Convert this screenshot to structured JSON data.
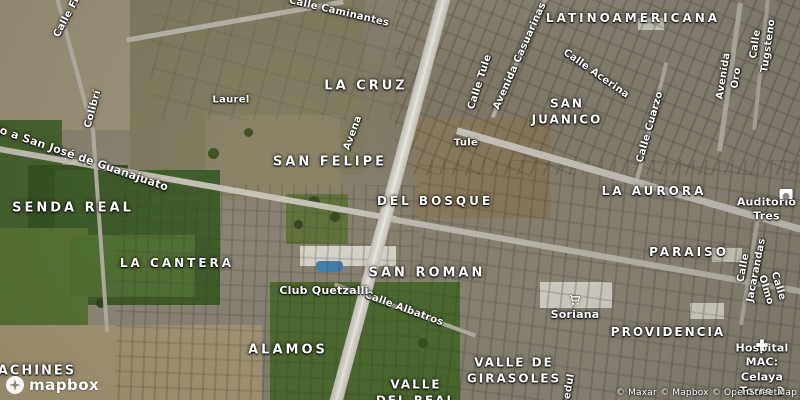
{
  "map": {
    "attribution": "© Maxar © Mapbox © OpenStreetMap",
    "logo_text": "mapbox",
    "colors": {
      "label": "#ffffff",
      "label_halo": "#1f1f1f",
      "highway": "#d4d1c8",
      "field_green": "#46612c",
      "pool_blue": "#3f7fae"
    },
    "area_labels": [
      {
        "text": "LATINOAMERICANA",
        "x": 633,
        "y": 19,
        "s": 12,
        "ls": 3
      },
      {
        "text": "LA CRUZ",
        "x": 366,
        "y": 87,
        "s": 13,
        "ls": 3
      },
      {
        "text": "SAN\nJUANICO",
        "x": 567,
        "y": 112,
        "s": 12,
        "ls": 2
      },
      {
        "text": "SAN FELIPE",
        "x": 330,
        "y": 163,
        "s": 13,
        "ls": 3
      },
      {
        "text": "LA AURORA",
        "x": 654,
        "y": 192,
        "s": 12,
        "ls": 3
      },
      {
        "text": "SENDA REAL",
        "x": 73,
        "y": 209,
        "s": 13,
        "ls": 3
      },
      {
        "text": "DEL BOSQUE",
        "x": 435,
        "y": 202,
        "s": 12,
        "ls": 3
      },
      {
        "text": "PARAISO",
        "x": 689,
        "y": 253,
        "s": 12,
        "ls": 3
      },
      {
        "text": "LA CANTERA",
        "x": 177,
        "y": 264,
        "s": 12,
        "ls": 3
      },
      {
        "text": "SAN ROMAN",
        "x": 427,
        "y": 274,
        "s": 13,
        "ls": 3
      },
      {
        "text": "PROVIDENCIA",
        "x": 668,
        "y": 333,
        "s": 12,
        "ls": 2
      },
      {
        "text": "ALAMOS",
        "x": 288,
        "y": 351,
        "s": 13,
        "ls": 3
      },
      {
        "text": "VALLE DE\nGIRASOLES",
        "x": 514,
        "y": 371,
        "s": 12,
        "ls": 2
      },
      {
        "text": "VALLE\nDEL REAL",
        "x": 416,
        "y": 393,
        "s": 12,
        "ls": 2
      },
      {
        "text": "BACHINES",
        "x": 31,
        "y": 372,
        "s": 13,
        "ls": 2
      }
    ],
    "street_labels": [
      {
        "text": "Calle Caminantes",
        "x": 339,
        "y": 12,
        "r": 13
      },
      {
        "text": "Calle Fr",
        "x": 67,
        "y": 17,
        "r": -62
      },
      {
        "text": "Calle Acerina",
        "x": 596,
        "y": 74,
        "r": 35
      },
      {
        "text": "Avenida Casuarinas",
        "x": 520,
        "y": 56,
        "r": -66
      },
      {
        "text": "Calle Tule",
        "x": 480,
        "y": 82,
        "r": -72
      },
      {
        "text": "Avenida Oro",
        "x": 730,
        "y": 77,
        "r": -81
      },
      {
        "text": "Calle Tugsteno",
        "x": 762,
        "y": 45,
        "r": -82
      },
      {
        "text": "Calle Cuarzo",
        "x": 650,
        "y": 127,
        "r": -74
      },
      {
        "text": "Colibrí",
        "x": 93,
        "y": 109,
        "r": -75
      },
      {
        "text": "Laurel",
        "x": 231,
        "y": 100,
        "r": 0
      },
      {
        "text": "Avena",
        "x": 353,
        "y": 133,
        "r": -70
      },
      {
        "text": "Tule",
        "x": 466,
        "y": 143,
        "r": 0
      },
      {
        "text": "no a San José de Guanajuato",
        "x": 80,
        "y": 158,
        "r": 19,
        "s": 11
      },
      {
        "text": "Calle Albatros",
        "x": 404,
        "y": 309,
        "r": 20
      },
      {
        "text": "Calle Jacarandas",
        "x": 750,
        "y": 269,
        "r": -79
      },
      {
        "text": "Calle Olmo",
        "x": 772,
        "y": 288,
        "r": 73
      },
      {
        "text": "Abedul",
        "x": 568,
        "y": 394,
        "r": -80
      }
    ],
    "poi_labels": [
      {
        "text": "Club Quetzalli",
        "x": 324,
        "y": 291
      },
      {
        "text": "Soriana",
        "x": 575,
        "y": 315
      },
      {
        "text": "Auditorio Tres",
        "x": 733,
        "y": 210,
        "a": "l"
      },
      {
        "text": "Hospital MAC:\nCelaya Torre 2",
        "x": 762,
        "y": 370
      }
    ],
    "poi_icons": [
      {
        "name": "cart-icon",
        "x": 575,
        "y": 300,
        "size": 13
      },
      {
        "name": "auditorium-icon",
        "x": 786,
        "y": 194,
        "size": 15
      },
      {
        "name": "hospital-cross-icon",
        "x": 762,
        "y": 345,
        "size": 14
      }
    ]
  }
}
